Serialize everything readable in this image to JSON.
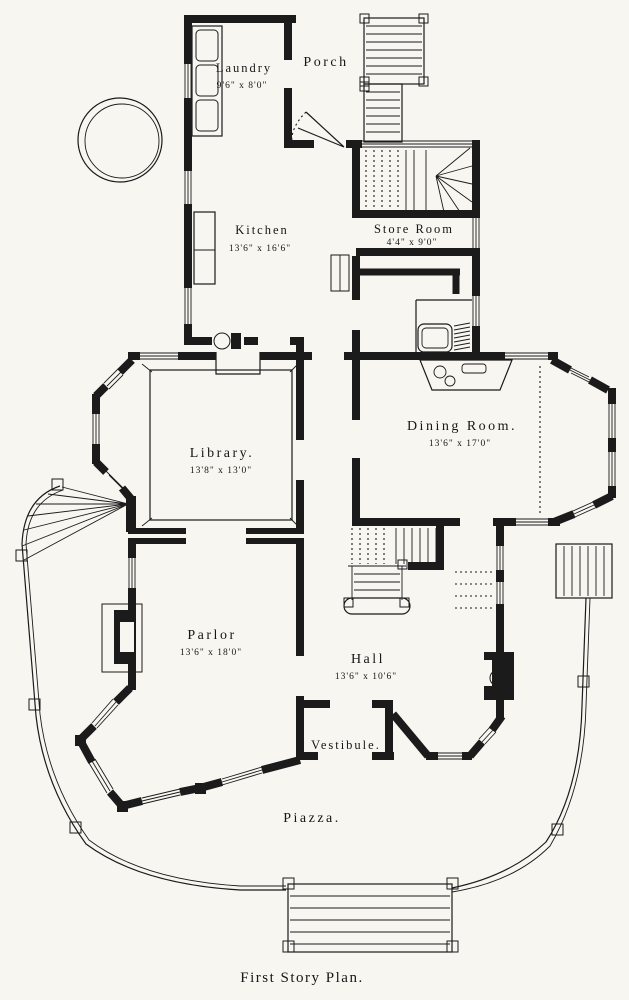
{
  "document": {
    "caption": "First Story Plan.",
    "paper_color": "#f7f6f1",
    "ink_color": "#1b1b1b"
  },
  "rooms": {
    "laundry": {
      "name": "Laundry",
      "dims": "9'6\" x 8'0\""
    },
    "porch": {
      "name": "Porch"
    },
    "kitchen": {
      "name": "Kitchen",
      "dims": "13'6\" x 16'6\""
    },
    "store_room": {
      "name": "Store Room",
      "dims": "4'4\" x 9'0\""
    },
    "library": {
      "name": "Library.",
      "dims": "13'8\" x 13'0\""
    },
    "dining_room": {
      "name": "Dining Room.",
      "dims": "13'6\" x 17'0\""
    },
    "parlor": {
      "name": "Parlor",
      "dims": "13'6\" x 18'0\""
    },
    "hall": {
      "name": "Hall",
      "dims": "13'6\" x 10'6\""
    },
    "vestibule": {
      "name": "Vestibule."
    },
    "piazza": {
      "name": "Piazza."
    }
  }
}
